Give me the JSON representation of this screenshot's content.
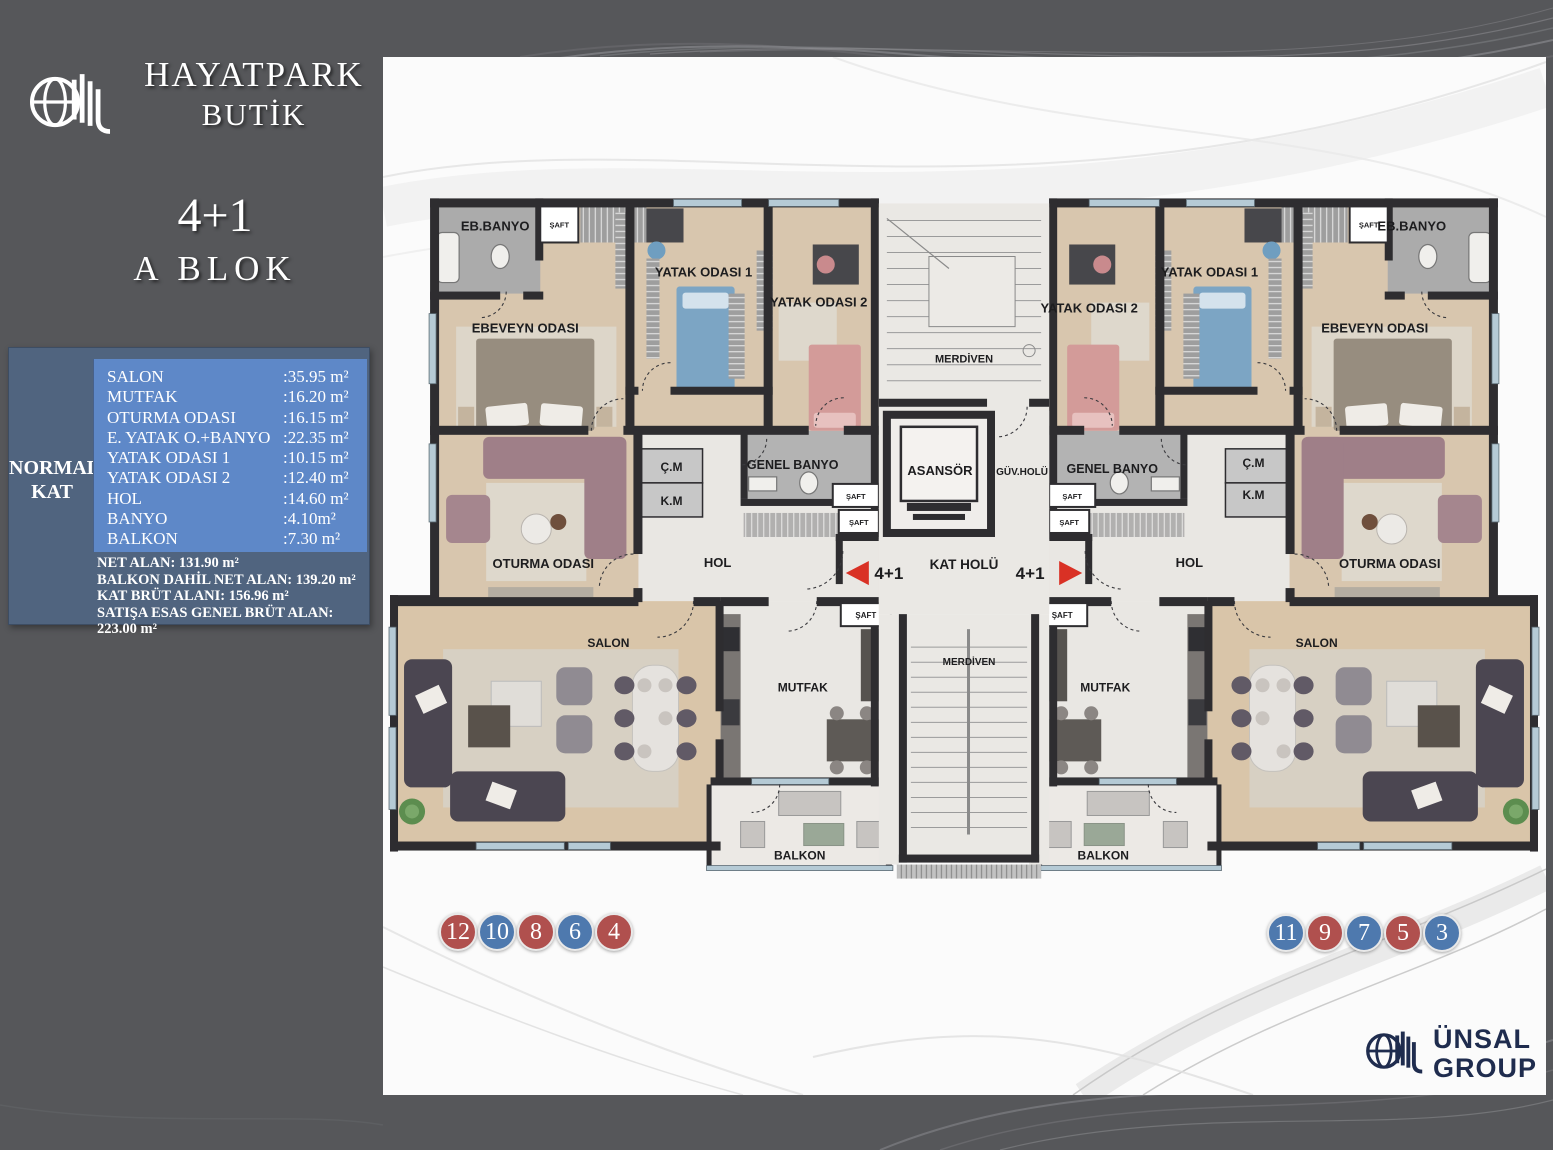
{
  "colors": {
    "bg-dark": "#56575a",
    "info-slate": "#50647f",
    "info-blue": "#5e88c8",
    "circle-red": "#b0504e",
    "circle-blue": "#4e79ae",
    "arrow-red": "#d93125",
    "navy": "#1f2c4e"
  },
  "header": {
    "brand_line1": "HAYATPARK",
    "brand_line2": "BUTİK",
    "unit_type": "4+1",
    "block": "A  BLOK"
  },
  "info_box": {
    "floor_line1": "NORMAL",
    "floor_line2": "KAT",
    "rooms": [
      {
        "name": "SALON",
        "area": ":35.95 m²"
      },
      {
        "name": "MUTFAK",
        "area": ":16.20 m²"
      },
      {
        "name": "OTURMA ODASI",
        "area": ":16.15 m²"
      },
      {
        "name": "E. YATAK O.+BANYO",
        "area": ":22.35 m²"
      },
      {
        "name": "YATAK ODASI 1",
        "area": ":10.15 m²"
      },
      {
        "name": "YATAK ODASI 2",
        "area": ":12.40 m²"
      },
      {
        "name": "HOL",
        "area": ":14.60 m²"
      },
      {
        "name": "BANYO",
        "area": ":4.10m²"
      },
      {
        "name": "BALKON",
        "area": ":7.30 m²"
      }
    ],
    "totals": [
      "NET ALAN: 131.90 m²",
      "BALKON DAHİL NET ALAN: 139.20 m²",
      "KAT BRÜT ALANI: 156.96 m²",
      "SATIŞA ESAS GENEL BRÜT ALAN: 223.00 m²"
    ]
  },
  "plan": {
    "labels": {
      "eb_banyo": "EB.BANYO",
      "saft": "ŞAFT",
      "ebeveyn": "EBEVEYN ODASI",
      "yatak1": "YATAK ODASI 1",
      "yatak2": "YATAK ODASI 2",
      "oturma": "OTURMA ODASI",
      "cm": "Ç.M",
      "km": "K.M",
      "genel_banyo": "GENEL BANYO",
      "hol": "HOL",
      "salon": "SALON",
      "mutfak": "MUTFAK",
      "balkon": "BALKON",
      "merdiven": "MERDİVEN",
      "asansor": "ASANSÖR",
      "guv_holu": "GÜV.HOLÜ",
      "kat_holu": "KAT HOLÜ",
      "apt": "4+1"
    }
  },
  "circles": {
    "left": [
      {
        "label": "12",
        "cls": "circle red"
      },
      {
        "label": "10",
        "cls": "circle blue"
      },
      {
        "label": "8",
        "cls": "circle red"
      },
      {
        "label": "6",
        "cls": "circle blue"
      },
      {
        "label": "4",
        "cls": "circle red"
      }
    ],
    "right": [
      {
        "label": "11",
        "cls": "circle blue"
      },
      {
        "label": "9",
        "cls": "circle red"
      },
      {
        "label": "7",
        "cls": "circle blue"
      },
      {
        "label": "5",
        "cls": "circle red"
      },
      {
        "label": "3",
        "cls": "circle blue"
      }
    ]
  },
  "footer_logo": {
    "line1": "ÜNSAL",
    "line2": "GROUP"
  }
}
